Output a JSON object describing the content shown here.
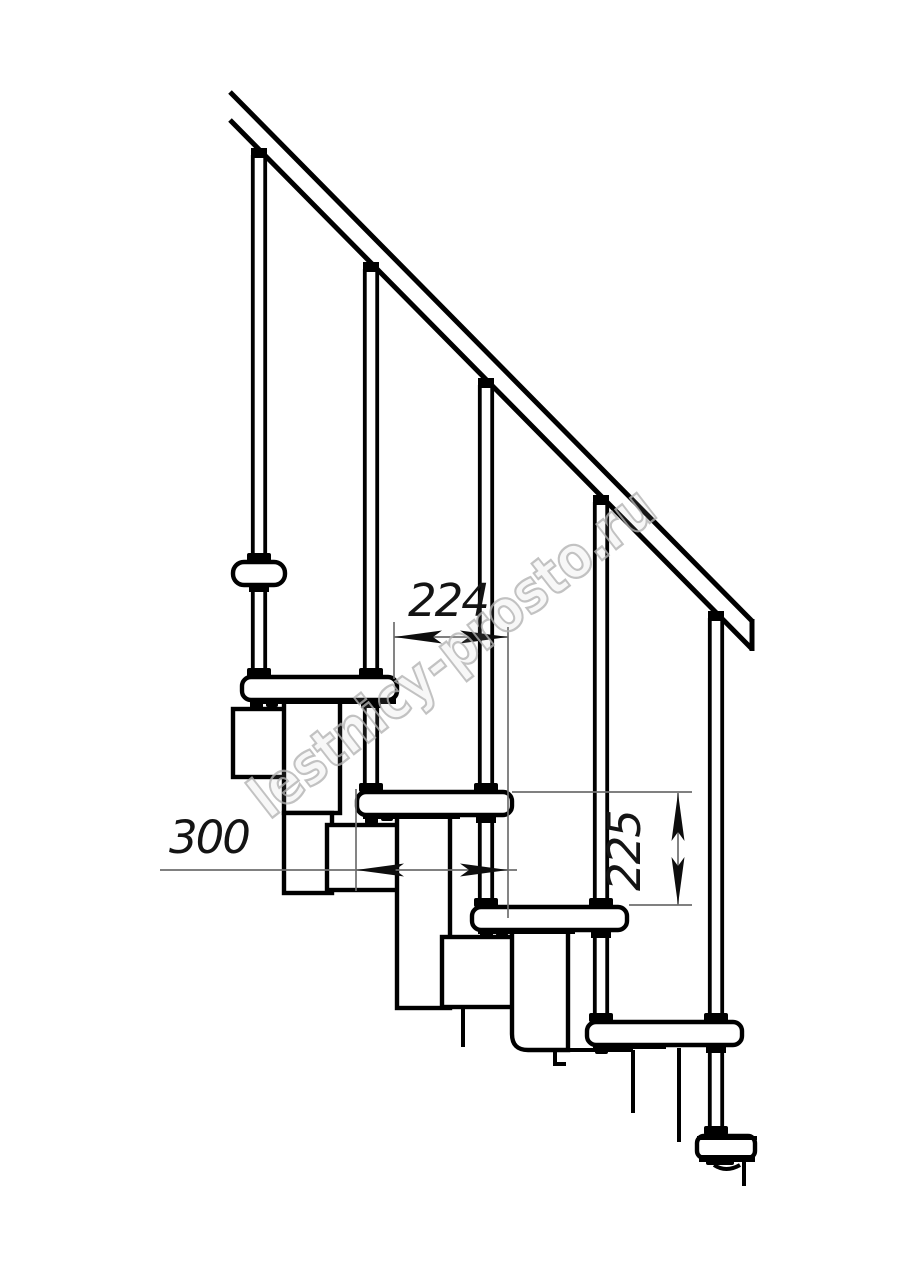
{
  "drawing": {
    "title": "modular-staircase-side-elevation",
    "dimensions": {
      "horizontal_spacing": "224",
      "module_depth": "300",
      "vertical_rise": "225"
    },
    "watermark_text": "lestnicy-prosto.ru",
    "colors": {
      "line": "#000000",
      "dim_line": "#6f6f6f",
      "dim_text": "#141414",
      "watermark": "#b3b3b3",
      "background": "#ffffff"
    }
  }
}
